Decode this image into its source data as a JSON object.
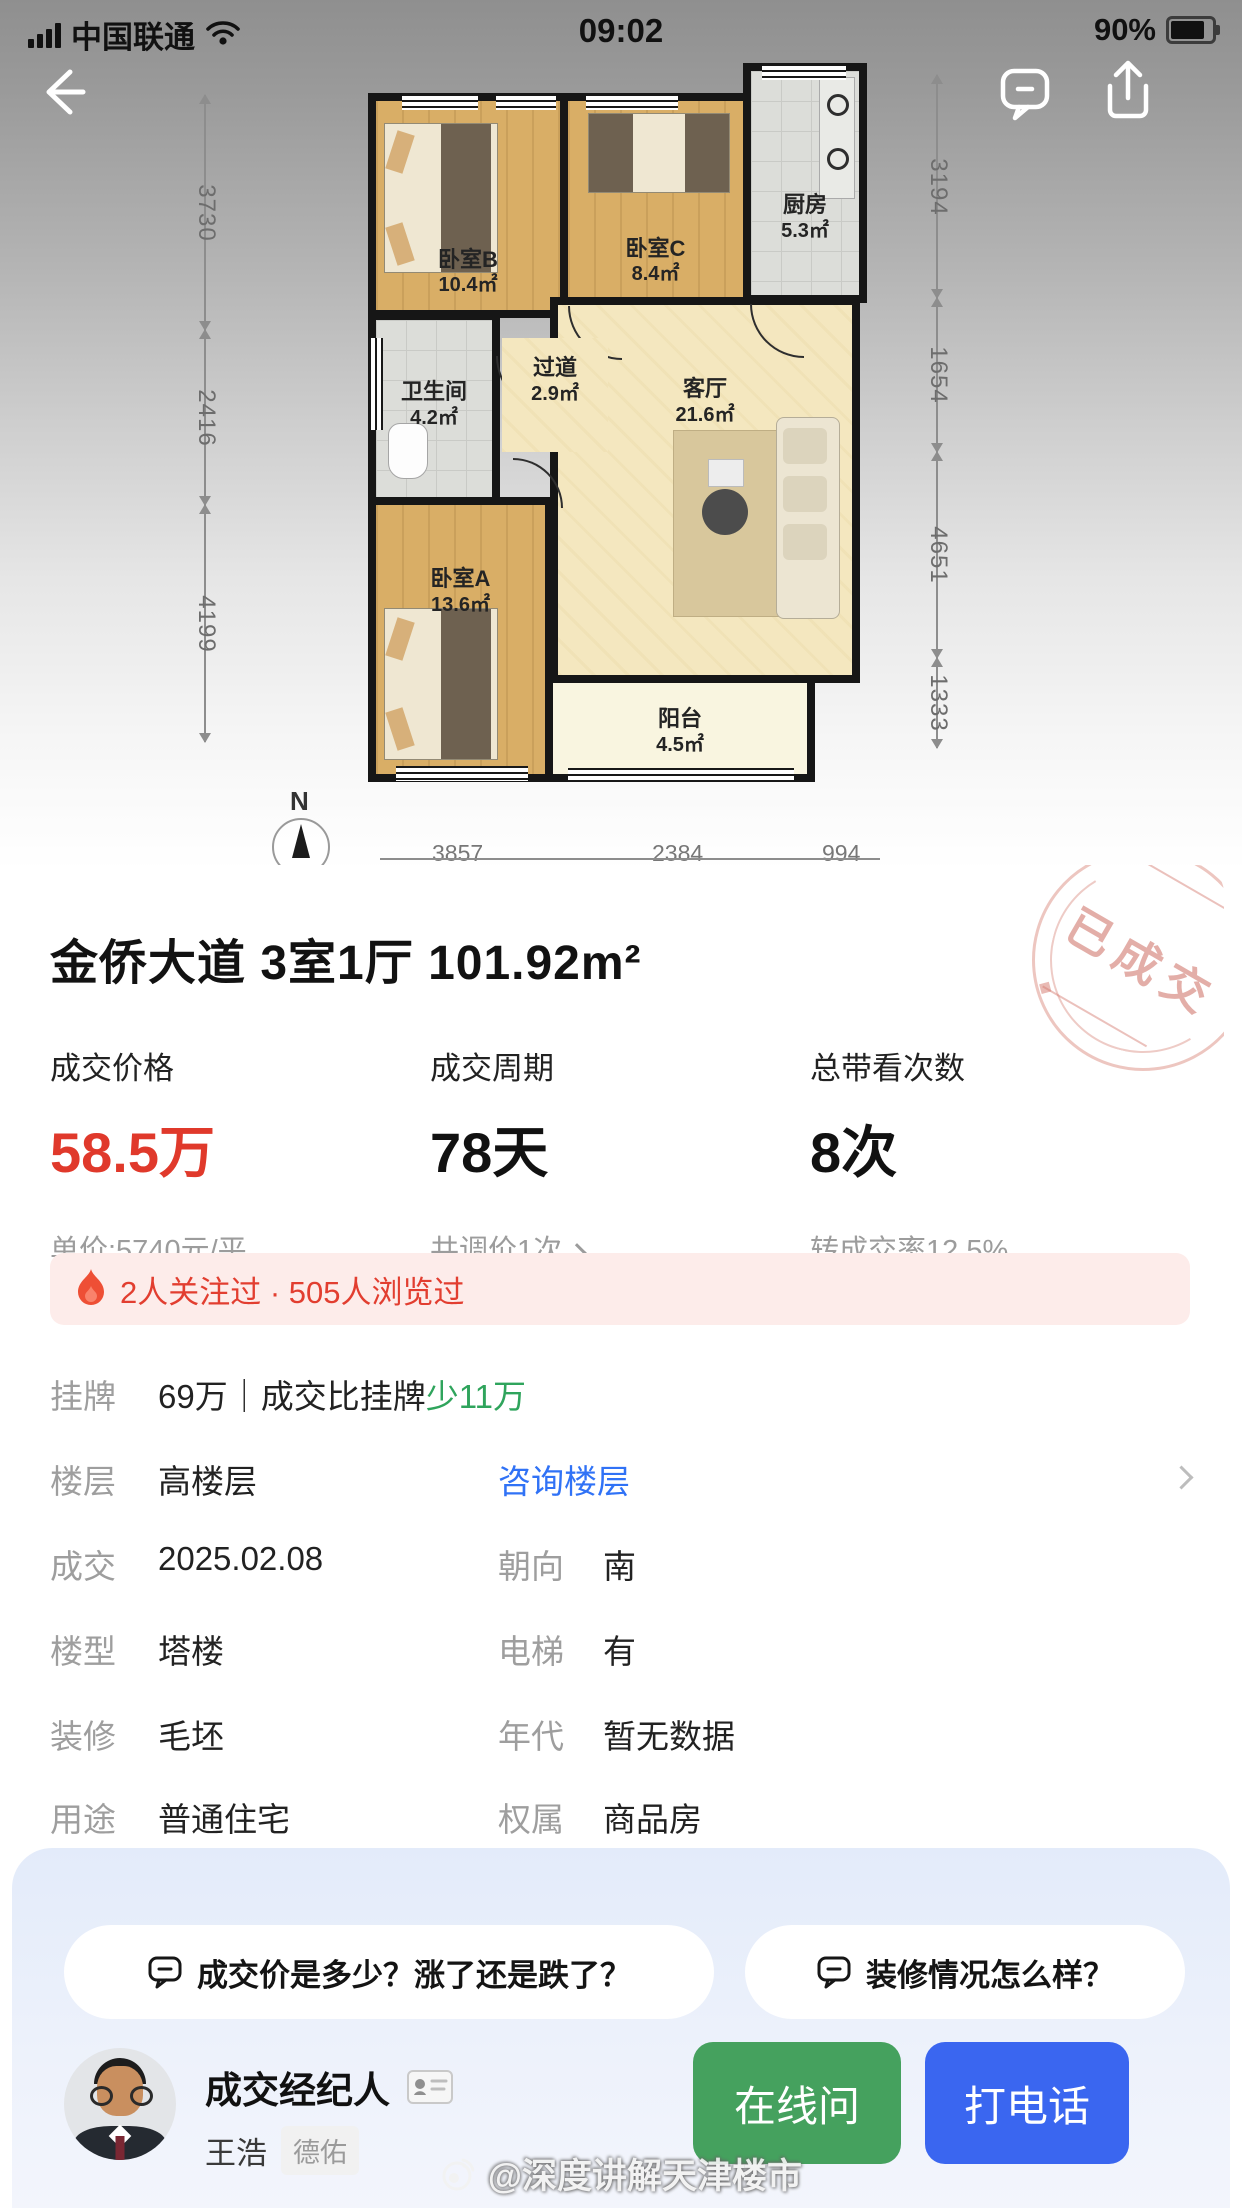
{
  "status_bar": {
    "carrier": "中国联通",
    "time": "09:02",
    "battery_percent": "90%"
  },
  "floorplan": {
    "rooms": [
      {
        "name": "卧室B",
        "area": "10.4㎡"
      },
      {
        "name": "卧室C",
        "area": "8.4㎡"
      },
      {
        "name": "厨房",
        "area": "5.3㎡"
      },
      {
        "name": "卫生间",
        "area": "4.2㎡"
      },
      {
        "name": "过道",
        "area": "2.9㎡"
      },
      {
        "name": "客厅",
        "area": "21.6㎡"
      },
      {
        "name": "卧室A",
        "area": "13.6㎡"
      },
      {
        "name": "阳台",
        "area": "4.5㎡"
      }
    ],
    "dims_left": [
      "3730",
      "2416",
      "4199"
    ],
    "dims_right": [
      "3194",
      "1654",
      "4651",
      "1333"
    ],
    "dims_bottom": [
      "3857",
      "2384",
      "994"
    ],
    "compass": "N"
  },
  "card": {
    "title": "金侨大道 3室1厅 101.92m²",
    "stamp": "已成交",
    "stats": [
      {
        "label": "成交价格",
        "value": "58.5万",
        "sub": "单价:5740元/平"
      },
      {
        "label": "成交周期",
        "value": "78天",
        "sub": "共调价1次"
      },
      {
        "label": "总带看次数",
        "value": "8次",
        "sub": "转成交率12.5%"
      }
    ],
    "notice": "2人关注过 · 505人浏览过",
    "listing_row": {
      "label": "挂牌",
      "value": "69万｜成交比挂牌",
      "highlight": "少11万"
    },
    "info_rows": [
      {
        "label": "楼层",
        "value": "高楼层",
        "link": "咨询楼层"
      },
      {
        "label": "成交",
        "value": "2025.02.08",
        "label2": "朝向",
        "value2": "南"
      },
      {
        "label": "楼型",
        "value": "塔楼",
        "label2": "电梯",
        "value2": "有"
      },
      {
        "label": "装修",
        "value": "毛坯",
        "label2": "年代",
        "value2": "暂无数据"
      },
      {
        "label": "用途",
        "value": "普通住宅",
        "label2": "权属",
        "value2": "商品房"
      }
    ]
  },
  "bottom": {
    "chips": [
      "成交价是多少？涨了还是跌了？",
      "装修情况怎么样？"
    ],
    "agent": {
      "role": "成交经纪人",
      "name": "王浩",
      "company": "德佑"
    },
    "buttons": {
      "online": "在线问",
      "call": "打电话"
    },
    "watermark": "@深度讲解天津楼市"
  },
  "colors": {
    "price_red": "#e0392b",
    "highlight_green": "#2fa45c",
    "link_blue": "#3072f6",
    "btn_green": "#45a15e",
    "btn_blue": "#3a66f0",
    "stamp_pink": "#cc6c60",
    "notice_bg": "#fdecea",
    "panel_blue": "#e3ebfa"
  }
}
